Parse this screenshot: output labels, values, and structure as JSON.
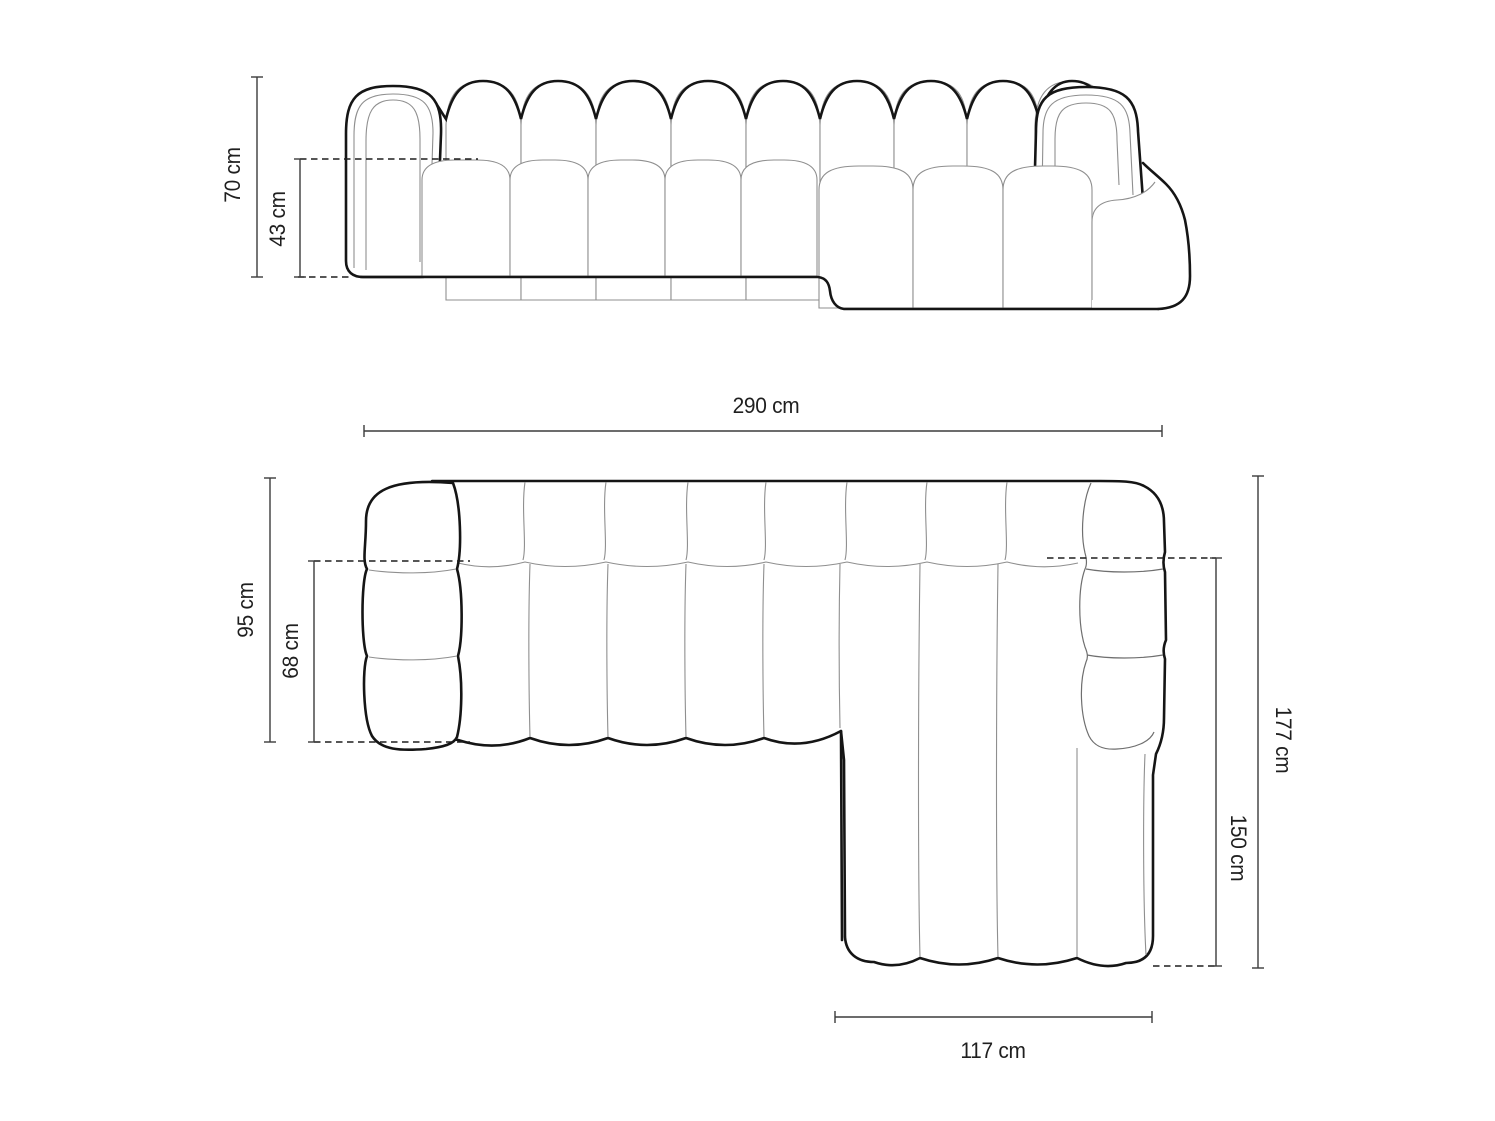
{
  "front_view": {
    "dims": {
      "total_height": "70 cm",
      "seat_height": "43 cm"
    }
  },
  "top_view": {
    "dims": {
      "total_width": "290 cm",
      "total_depth": "95 cm",
      "seat_depth": "68 cm",
      "chaise_side_total_depth": "177 cm",
      "chaise_length": "150 cm",
      "chaise_width": "117 cm"
    }
  },
  "colors": {
    "background": "#ffffff",
    "outline_bold": "#151515",
    "outline_thin": "#8f8f8f",
    "outline_medium": "#6f6f6f",
    "dimension_line": "#3c3c3c",
    "dashed_line": "#1f1f1f",
    "text": "#1f1f1f"
  }
}
